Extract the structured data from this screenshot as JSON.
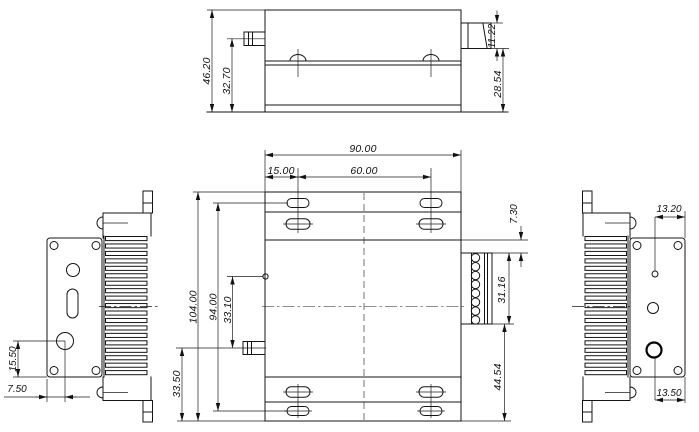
{
  "drawing_title": "multi-view mechanical drawing of finned module enclosure",
  "views": {
    "top": {
      "label": "top view",
      "dims": {
        "overall_height": "46.20",
        "body_height": "32.70",
        "connector_height": "11.22",
        "connector_to_base": "28.54"
      }
    },
    "front": {
      "label": "front view",
      "dims": {
        "overall_width": "90.00",
        "slot_left_offset": "15.00",
        "slot_spacing": "60.00",
        "overall_height": "104.00",
        "slot_row_spacing": "94.00",
        "hole_to_stud": "33.10",
        "stud_to_bottom": "33.50",
        "edge_to_connector": "7.30",
        "connector_height": "31.16",
        "connector_to_bottom": "44.54"
      }
    },
    "left": {
      "label": "left side view",
      "dims": {
        "hole_to_bottom_edge": "15.50",
        "edge_to_hole": "7.50"
      }
    },
    "right": {
      "label": "right side view",
      "dims": {
        "hole_to_edge_top": "13.20",
        "hole_to_edge_bottom": "13.50"
      }
    }
  }
}
